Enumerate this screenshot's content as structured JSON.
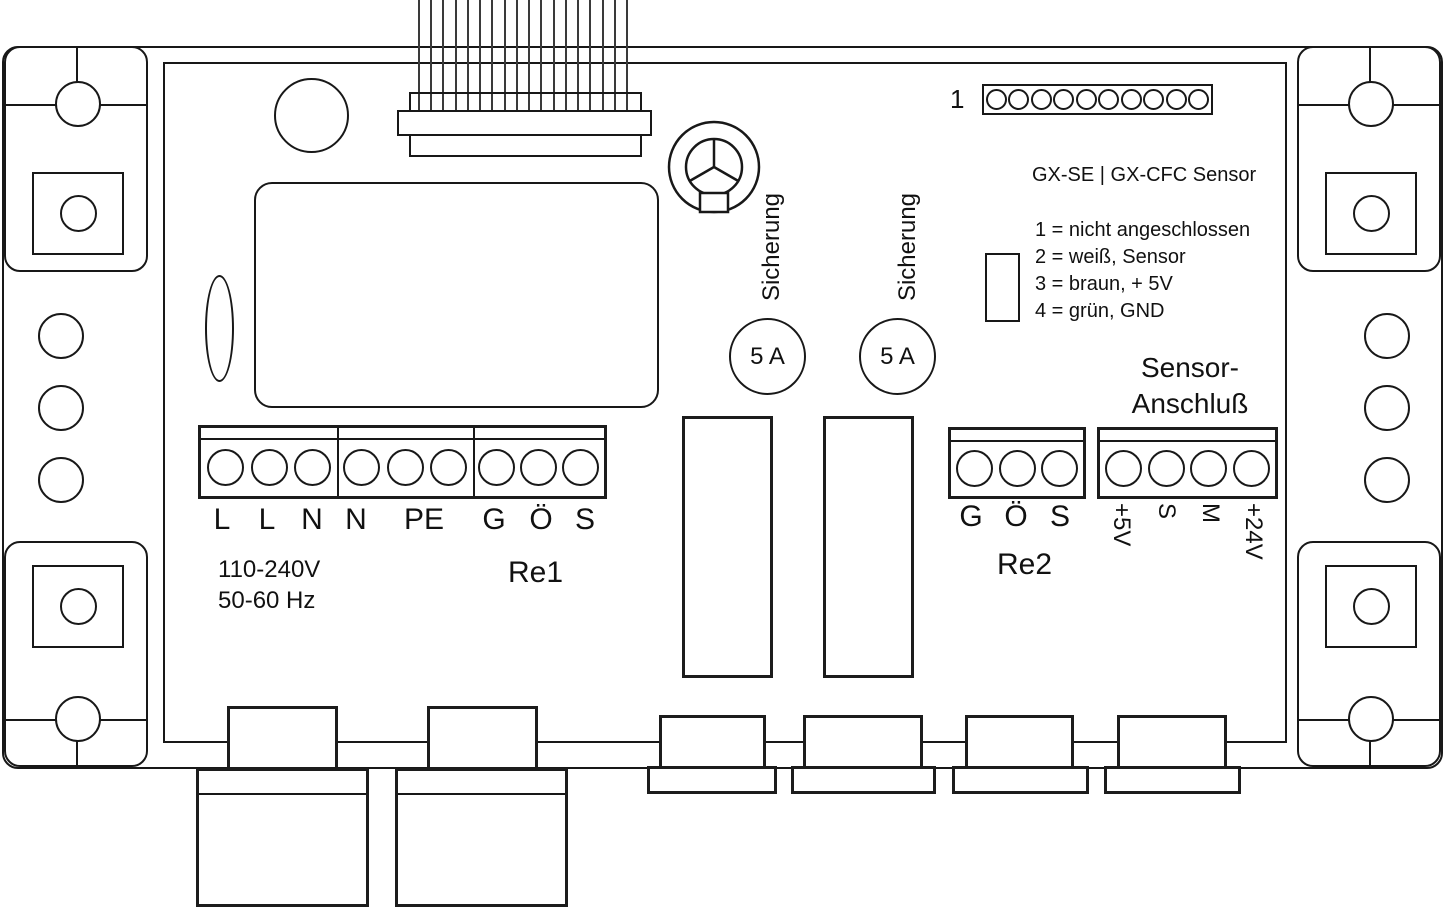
{
  "header_pins": {
    "index_label": "1",
    "count": 10
  },
  "sensor_info": {
    "title": "GX-SE | GX-CFC Sensor",
    "legend": [
      "1 = nicht angeschlossen",
      "2 = weiß, Sensor",
      "3 = braun, + 5V",
      "4 = grün, GND"
    ]
  },
  "ribbon": {
    "wire_count": 18
  },
  "fuses": {
    "label": "Sicherung",
    "rating": "5 A"
  },
  "power_block": {
    "pins_per_section": 3,
    "labels": [
      "L",
      "L",
      "N",
      "N",
      "PE",
      "G",
      "Ö",
      "S"
    ],
    "voltage": "110-240V",
    "frequency": "50-60 Hz",
    "relay_label": "Re1"
  },
  "relay2_block": {
    "pins": 3,
    "labels": [
      "G",
      "Ö",
      "S"
    ],
    "relay_label": "Re2"
  },
  "sensor_block": {
    "pins": 4,
    "title_line1": "Sensor-",
    "title_line2": "Anschluß",
    "pin_labels": [
      "+5V",
      "S",
      "M",
      "+24V"
    ]
  }
}
